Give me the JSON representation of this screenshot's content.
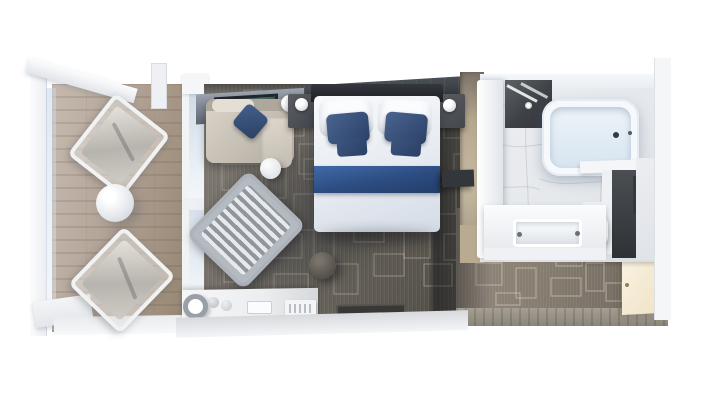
{
  "scene": {
    "type": "3d-floorplan-render",
    "name": "Balcony stateroom floor plan — top-down 3D render",
    "background": "#ffffff"
  },
  "palette": {
    "carpet": "#6f6a62",
    "carpet_pattern": "#d6cfc0",
    "corridor_carpet": "#8a8177",
    "balcony_wood": "#b1a496",
    "headboard_wall": "#2c3036",
    "slate_wall": "#6b747f",
    "accent_navy": "#2f4d7d",
    "upholstery_greige": "#c9c2b7",
    "marble": "#e9ebee",
    "divider_wood": "#c0b299",
    "fixture_white": "#f7f9fb",
    "entry_door_cream": "#f2e8d4",
    "artwork_teal": "#3a5a58"
  },
  "rooms": {
    "balcony": {
      "name": "balcony",
      "items": [
        "glass railing",
        "privacy divider",
        "lounge chair",
        "lounge chair",
        "round table",
        "wood deck"
      ]
    },
    "living_area": {
      "name": "living area",
      "items": [
        "sofa with navy pillow",
        "floor lamp",
        "round side table",
        "striped armchair",
        "round ottoman",
        "vanity desk with mirror",
        "stools",
        "tray",
        "amenity tray",
        "framed artwork",
        "sliding glass door"
      ]
    },
    "bedroom": {
      "name": "bedroom",
      "items": [
        "queen bed with white duvet",
        "navy accent pillows",
        "navy bed runner",
        "nightstand with lamp",
        "nightstand with lamp",
        "headboard wall",
        "wall shelf"
      ]
    },
    "bathroom": {
      "name": "bathroom",
      "items": [
        "bathtub",
        "walk-in shower",
        "vanity sink",
        "toilet",
        "framed picture",
        "marble floor",
        "glass partition",
        "door panel"
      ]
    },
    "entry": {
      "name": "entry corridor",
      "items": [
        "entry door",
        "corridor carpet",
        "threshold"
      ]
    }
  }
}
